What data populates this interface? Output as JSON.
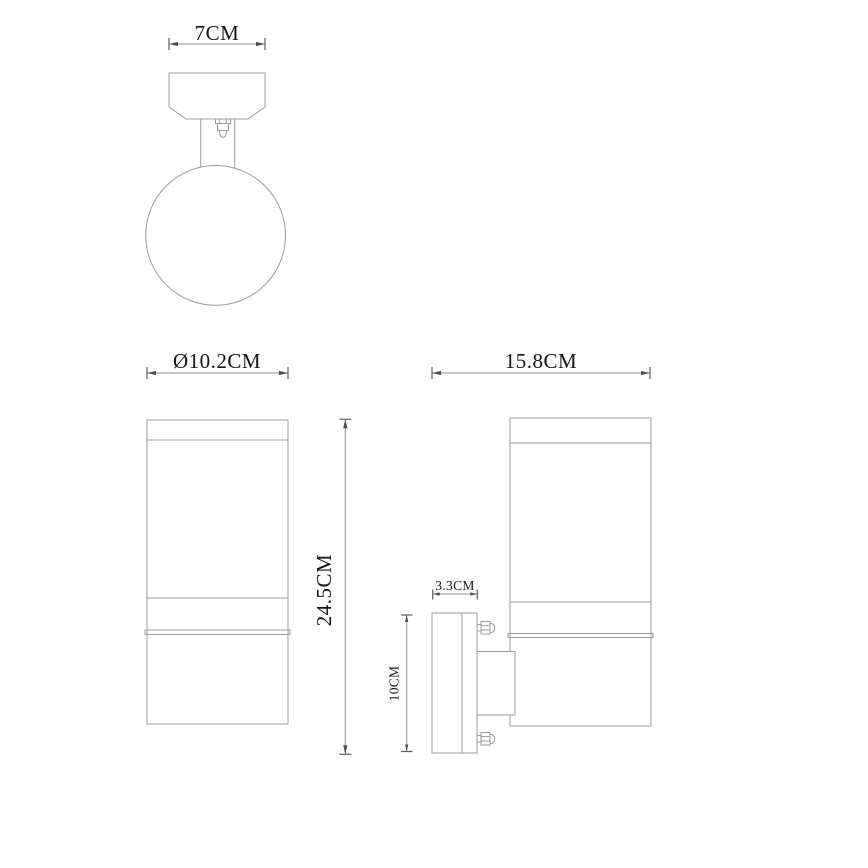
{
  "drawing": {
    "colors": {
      "background": "#ffffff",
      "object_line": "#9c9c9c",
      "dimension_line": "#8f8f8f",
      "text": "#161616"
    },
    "views": {
      "top": {
        "dim_width": {
          "label": "7CM",
          "value_cm": 7
        }
      },
      "front": {
        "dim_diameter": {
          "label": "Ø10.2CM",
          "value_cm": 10.2
        },
        "dim_height": {
          "label": "24.5CM",
          "value_cm": 24.5
        }
      },
      "side": {
        "dim_width": {
          "label": "15.8CM",
          "value_cm": 15.8
        },
        "dim_plate_depth": {
          "label": "3.3CM",
          "value_cm": 3.3
        },
        "dim_plate_height": {
          "label": "10CM",
          "value_cm": 10
        }
      }
    }
  }
}
